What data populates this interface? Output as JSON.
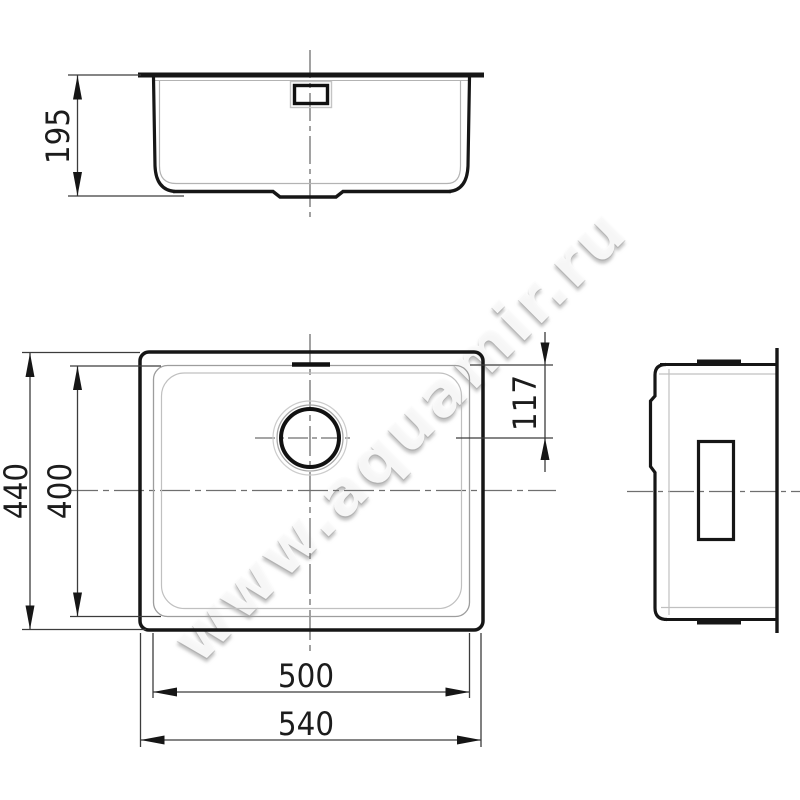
{
  "watermark": "www.aquamir.ru",
  "dimensions": {
    "front_height": "195",
    "outer_width": "540",
    "inner_width": "500",
    "outer_depth": "440",
    "inner_depth": "400",
    "drain_center_offset": "117"
  },
  "colors": {
    "line_primary": "#161616",
    "line_secondary": "#b3b3b3",
    "dimension_line": "#3c3c3c",
    "centerline": "#6f6f6f",
    "watermark_shadow": "#969696",
    "background": "#ffffff"
  }
}
